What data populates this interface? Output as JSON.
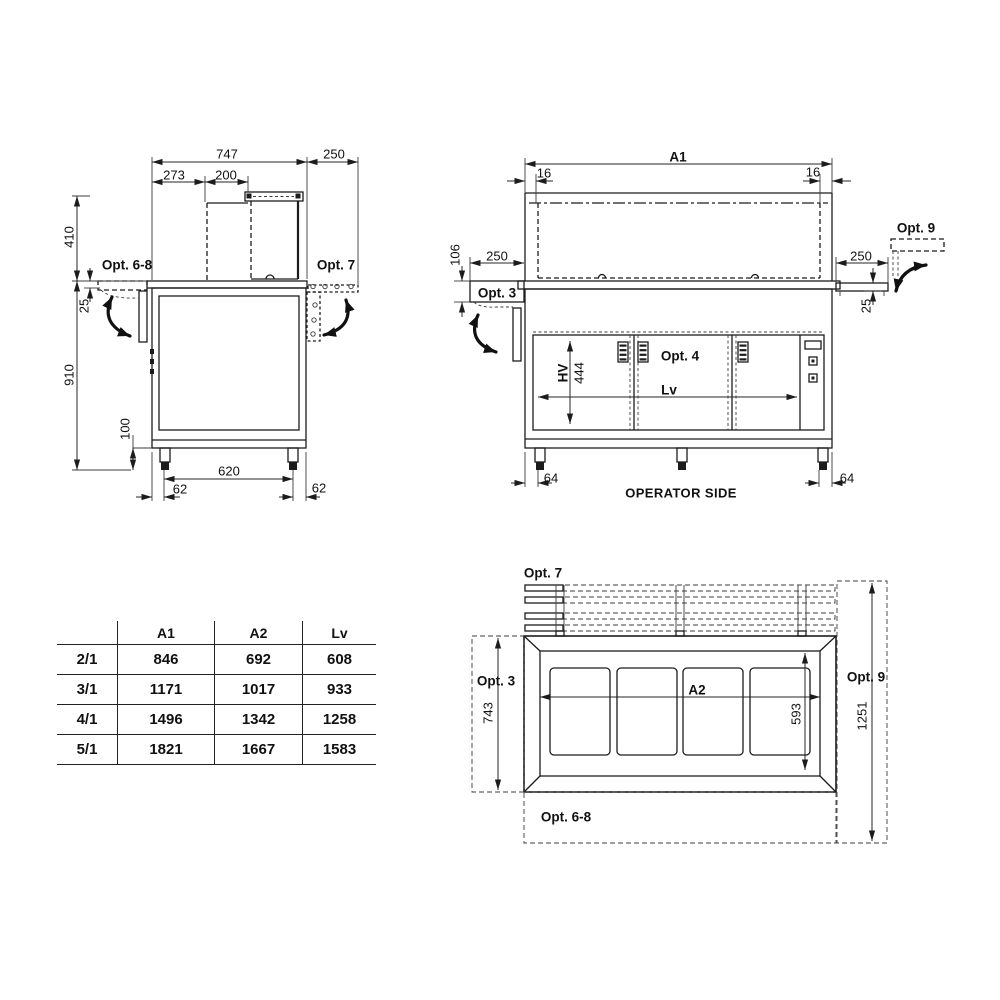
{
  "side_view": {
    "dim_total_width": "747",
    "dim_rail_depth": "250",
    "dim_273": "273",
    "dim_200": "200",
    "dim_410": "410",
    "dim_25": "25",
    "dim_910": "910",
    "dim_100": "100",
    "dim_620": "620",
    "dim_62_left": "62",
    "dim_62_right": "62",
    "opt_6_8": "Opt. 6-8",
    "opt_7": "Opt. 7"
  },
  "front_view": {
    "dim_a1": "A1",
    "dim_16_left": "16",
    "dim_16_right": "16",
    "dim_250_left": "250",
    "dim_106": "106",
    "opt_3": "Opt. 3",
    "dim_250_right": "250",
    "dim_25": "25",
    "opt_9": "Opt. 9",
    "opt_4": "Opt. 4",
    "dim_hv": "HV",
    "dim_444": "444",
    "dim_lv": "Lv",
    "dim_64_left": "64",
    "dim_64_right": "64",
    "caption": "OPERATOR SIDE"
  },
  "top_view": {
    "opt_7": "Opt. 7",
    "opt_3": "Opt. 3",
    "dim_743": "743",
    "dim_a2": "A2",
    "dim_593": "593",
    "opt_9": "Opt. 9",
    "dim_1251": "1251",
    "opt_6_8": "Opt. 6-8"
  },
  "size_table": {
    "headers": [
      "",
      "A1",
      "A2",
      "Lv"
    ],
    "rows": [
      {
        "model": "2/1",
        "a1": "846",
        "a2": "692",
        "lv": "608"
      },
      {
        "model": "3/1",
        "a1": "1171",
        "a2": "1017",
        "lv": "933"
      },
      {
        "model": "4/1",
        "a1": "1496",
        "a2": "1342",
        "lv": "1258"
      },
      {
        "model": "5/1",
        "a1": "1821",
        "a2": "1667",
        "lv": "1583"
      }
    ]
  },
  "colors": {
    "line": "#1c1c1e",
    "text": "#111111",
    "background": "#ffffff"
  }
}
